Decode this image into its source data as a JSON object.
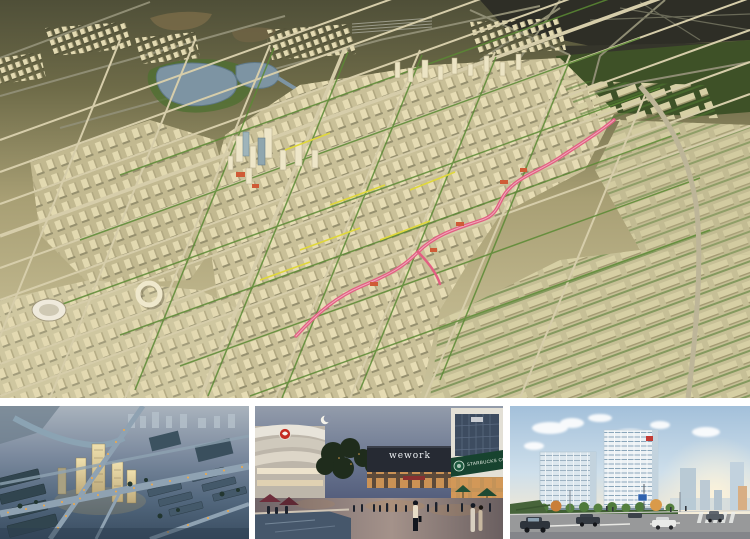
{
  "page": {
    "background": "#ffffff"
  },
  "panels": {
    "masterplan": {
      "alt": "Daytime aerial rendering of a new-town masterplan with cream towers, tree-lined diagonal streets, lakes and a winding pink pedestrian corridor",
      "colors": {
        "far_terrain": "#55543c",
        "dark_terrain": "#2e2e26",
        "forest": "#3e5127",
        "city_base": "#c9c098",
        "building_cream": "#e6dcb4",
        "lake_blue": "#7d94a3",
        "street": "#d6cdaa",
        "greenway": "#5b8a34",
        "corridor_pink": "#e25f82",
        "accent_yellow": "#e0d83a",
        "accent_red": "#cf5b36"
      }
    },
    "night_aerial": {
      "alt": "Dusk aerial rendering of a residential district with lit towers and streetlight-lined roads",
      "colors": {
        "sky_haze": "#a9b3bd",
        "ground_blue": "#3a4d61",
        "road": "#8fa2b2",
        "streetlight_orange": "#f2a946",
        "lit_tower": "#efe0ae"
      }
    },
    "plaza": {
      "alt": "Twilight retail plaza with crescent moon, trees, pedestrians, reflecting pool and storefronts",
      "signs": {
        "wework": "wework",
        "starbucks": "STARBUCKS COFFEE"
      },
      "colors": {
        "sky_top": "#939cab",
        "sky_bottom": "#555f7d",
        "starbucks_green": "#17432f",
        "logo_red": "#c42a20",
        "umbrella_green": "#245137",
        "warm_light": "#d89a58"
      }
    },
    "offices": {
      "alt": "Daytime street view of modern glass office buildings with autumn trees and traffic",
      "colors": {
        "sky": "#a3c0da",
        "glass": "#8fadc0",
        "frame_white": "#edf2f5",
        "road": "#98999a",
        "autumn_tree": "#c97f3a",
        "logo_red": "#c23a34"
      }
    }
  }
}
